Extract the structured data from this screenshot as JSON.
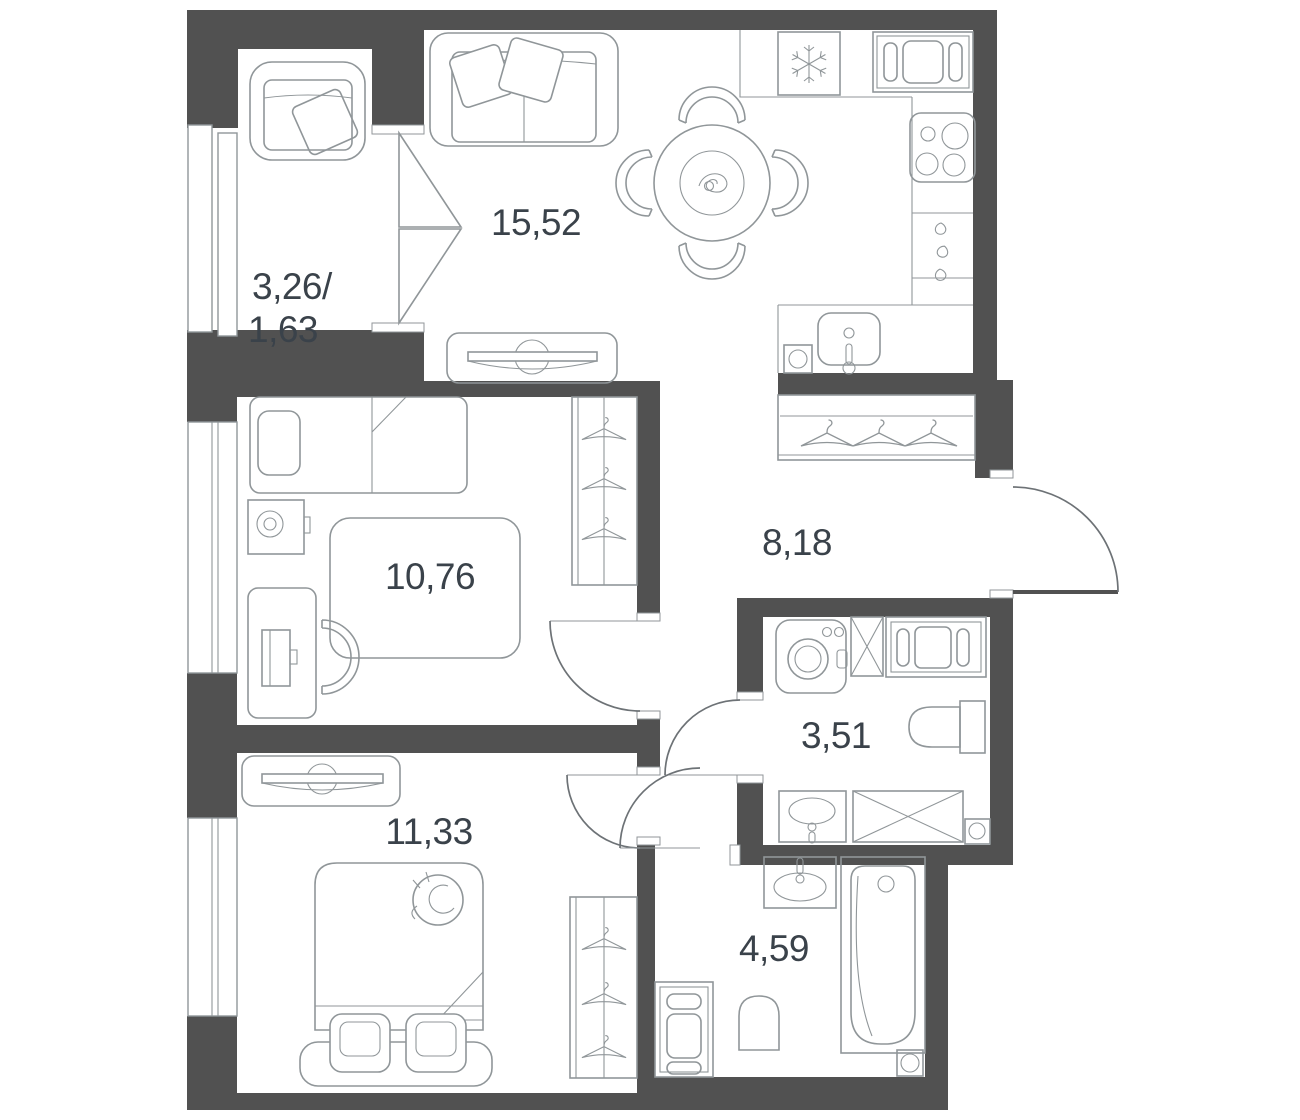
{
  "colors": {
    "wall": "#515151",
    "line": "#909699",
    "text": "#3a424a",
    "floor": "#ffffff"
  },
  "rooms": [
    {
      "id": "balcony",
      "name": "balcony",
      "area_label_line1": "3,26/",
      "area_label_line2": "1,63"
    },
    {
      "id": "living-kitchen",
      "name": "living room / kitchen",
      "area_label": "15,52"
    },
    {
      "id": "bedroom-1",
      "name": "bedroom",
      "area_label": "10,76"
    },
    {
      "id": "hallway",
      "name": "hallway",
      "area_label": "8,18"
    },
    {
      "id": "bathroom-small",
      "name": "bathroom",
      "area_label": "3,51"
    },
    {
      "id": "bedroom-2",
      "name": "bedroom",
      "area_label": "11,33"
    },
    {
      "id": "bathroom-main",
      "name": "bathroom",
      "area_label": "4,59"
    }
  ],
  "fixtures": {
    "balcony": [
      "armchair"
    ],
    "living_kitchen": [
      "sofa",
      "tv-stand",
      "dining-table",
      "dining-chairs",
      "fridge",
      "oven",
      "hob",
      "kitchen-drawers",
      "kitchen-sink"
    ],
    "bedroom_1": [
      "single-bed",
      "nightstand-lamp",
      "rug",
      "desk",
      "desk-chair",
      "monitor",
      "wardrobe-hangers"
    ],
    "hallway": [
      "wardrobe-hangers",
      "entrance-door"
    ],
    "bathroom_small": [
      "washing-machine",
      "vent-shaft",
      "dryer",
      "toilet",
      "sink",
      "shower-tray",
      "floor-drain"
    ],
    "bedroom_2": [
      "tv-stand",
      "double-bed",
      "cat",
      "bench-cushions",
      "wardrobe-hangers"
    ],
    "bathroom_main": [
      "sink",
      "bathtub",
      "toilet",
      "cabinet-column",
      "floor-drain"
    ]
  }
}
